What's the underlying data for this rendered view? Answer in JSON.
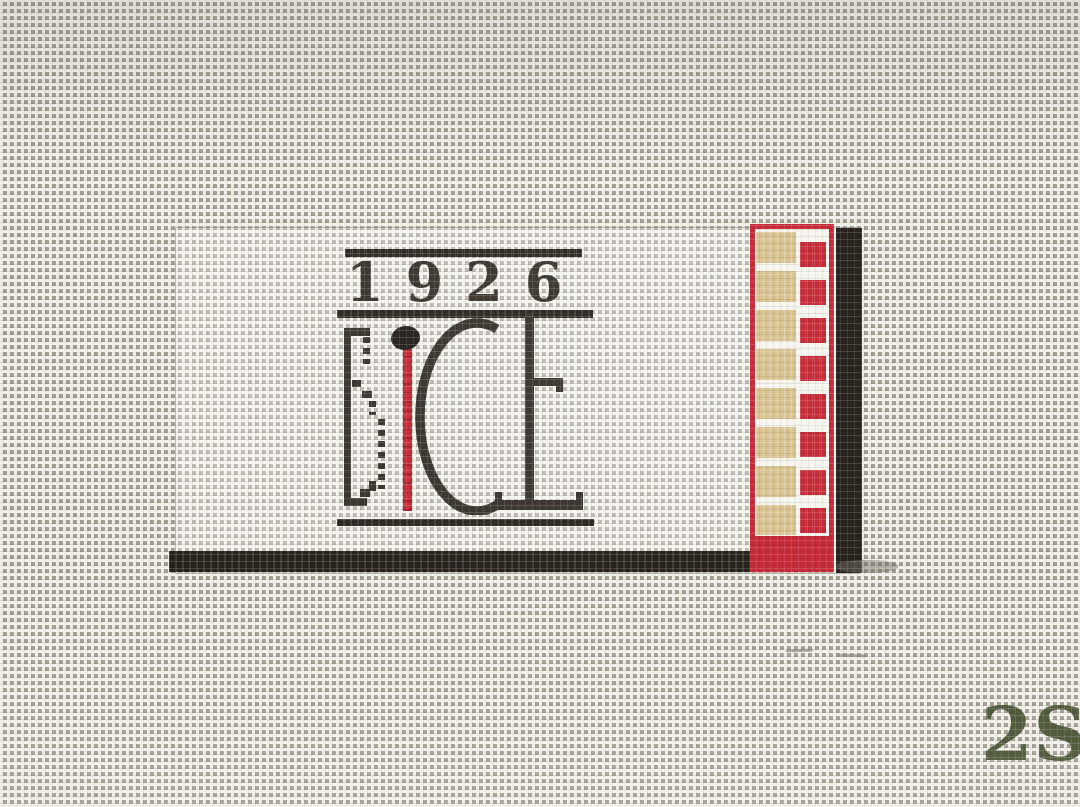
{
  "photo": {
    "year_text": "1926",
    "logo_text": "BiCE",
    "corner_mark": "2S"
  },
  "colors": {
    "charcoal": "#35302a",
    "bar_black": "#27231d",
    "shadow_black": "#211c16",
    "stitch_red": "#c62532",
    "match_tan": "#d9c28e",
    "moss_green": "#45502f",
    "pencil_gray": "#8b887e",
    "canvas_hole": "#a19e93",
    "canvas_thread": "#eeece4"
  },
  "matchbook_strip": {
    "tan_block_count": 8,
    "red_block_count": 8
  }
}
